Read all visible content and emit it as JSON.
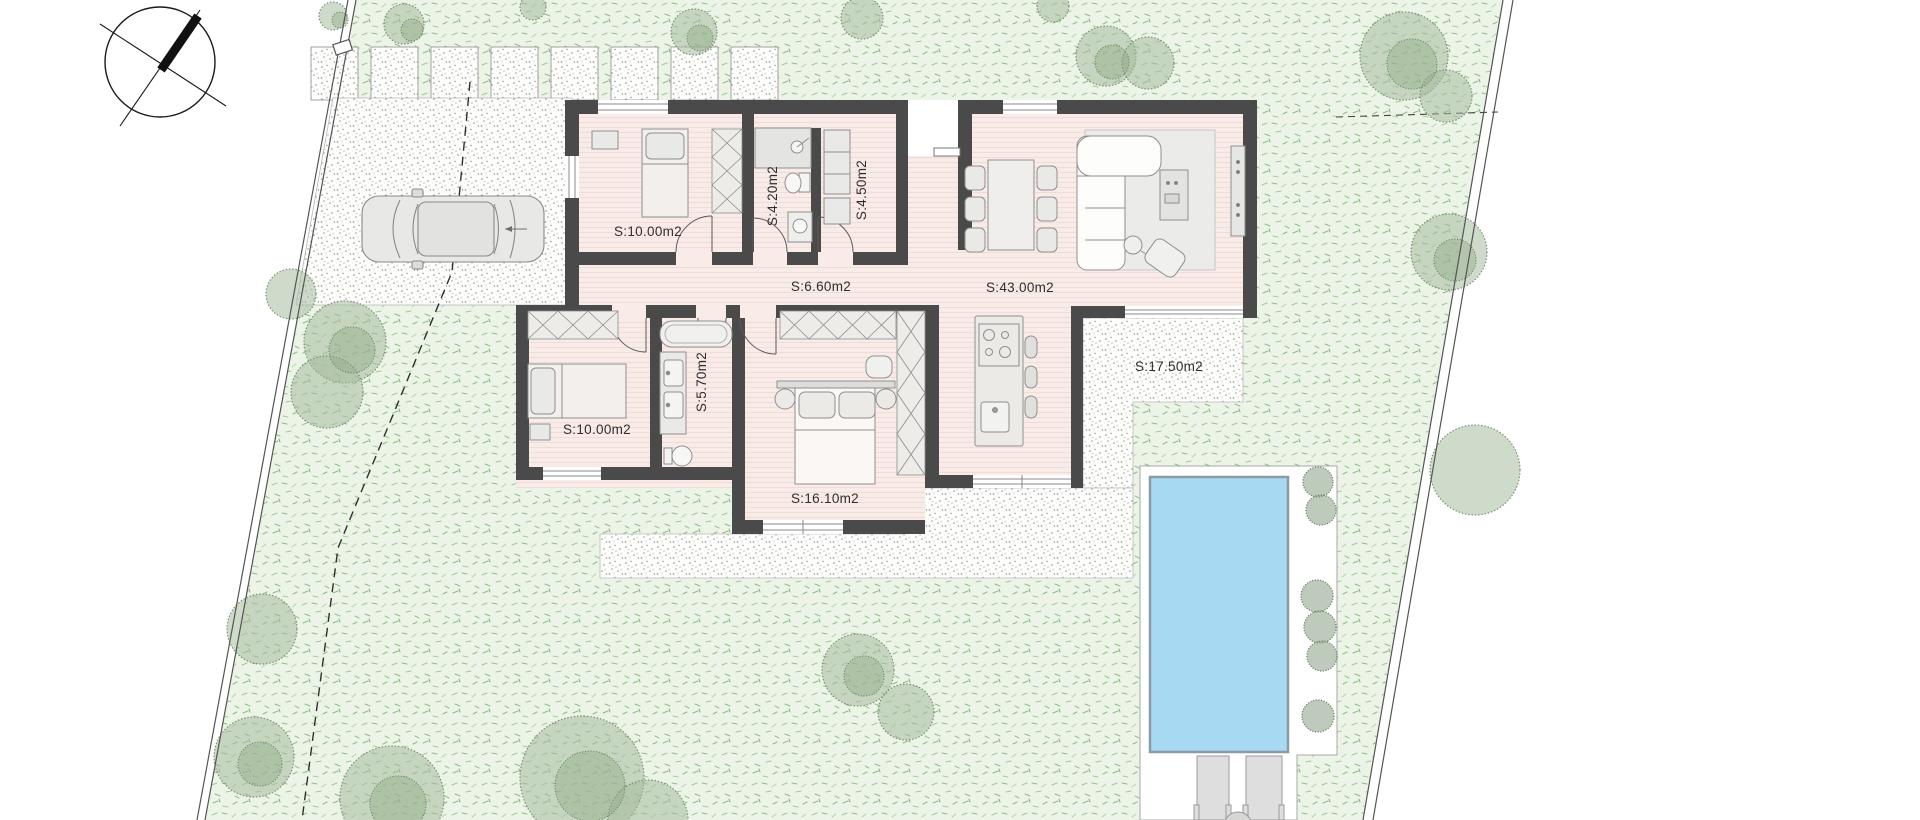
{
  "drawing": {
    "kind": "residential-site-floor-plan",
    "rooms": [
      {
        "id": "bedroom-1",
        "label": "S:10.00m2",
        "orientation": "horizontal"
      },
      {
        "id": "bathroom-1",
        "label": "S:4.20m2",
        "orientation": "vertical"
      },
      {
        "id": "utility-room",
        "label": "S:4.50m2",
        "orientation": "vertical"
      },
      {
        "id": "hallway",
        "label": "S:6.60m2",
        "orientation": "horizontal"
      },
      {
        "id": "living-dining-kitchen",
        "label": "S:43.00m2",
        "orientation": "horizontal"
      },
      {
        "id": "terrace",
        "label": "S:17.50m2",
        "orientation": "horizontal"
      },
      {
        "id": "bathroom-2",
        "label": "S:5.70m2",
        "orientation": "vertical"
      },
      {
        "id": "bedroom-2",
        "label": "S:10.00m2",
        "orientation": "horizontal"
      },
      {
        "id": "bedroom-3-master",
        "label": "S:16.10m2",
        "orientation": "horizontal"
      }
    ],
    "colors": {
      "wall": "#4a4a4a",
      "floor": "#f9ece8",
      "floor_line": "#efdbd4",
      "lawn": "#ecf4e7",
      "pool_water": "#a7daf2",
      "deck": "#ffffff",
      "furniture": "#e9e9e7",
      "furniture_stroke": "#8f8f8f",
      "stipple_dot": "#8e8e8e",
      "tree": "#8fa788",
      "label_ink": "#2e2e2e"
    },
    "features": [
      "north-arrow",
      "driveway",
      "car",
      "paver-path",
      "swimming-pool",
      "pool-deck",
      "sun-loungers",
      "terrace",
      "trees",
      "property-boundary"
    ]
  }
}
